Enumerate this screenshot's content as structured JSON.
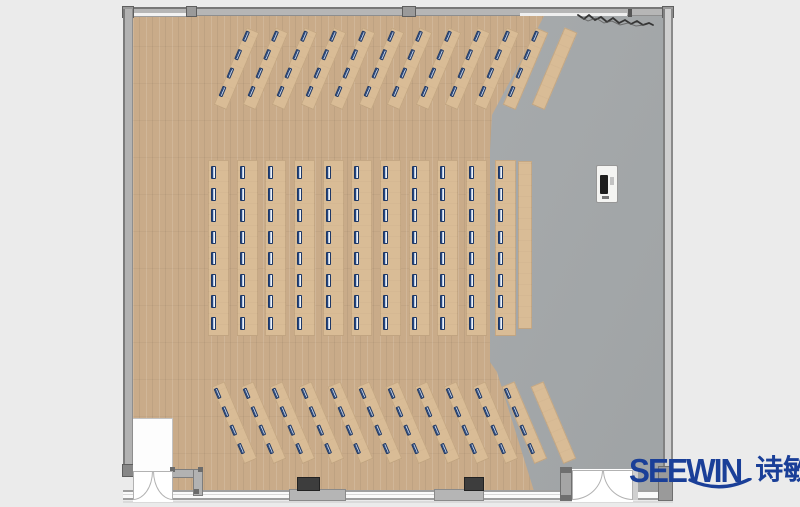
{
  "meta": {
    "title": "Training room floor plan (top view)",
    "floor_left": "wood plank",
    "floor_right": "gray"
  },
  "logo": {
    "brand": "SEEWIN",
    "cjk": "诗敏",
    "color": "#1a3f98"
  },
  "palette": {
    "background": "#ebebeb",
    "wood_floor": "#c9ab89",
    "gray_floor": "#a8acae",
    "desk": "#d9bc96",
    "seat_navy": "#1d3765",
    "wall": "#b6b6b6",
    "column_dark": "#3d3d3d",
    "logo_blue": "#1a3f98"
  },
  "furniture": {
    "blocks": [
      {
        "name": "top-desk-block",
        "angle": 23,
        "strips": 12,
        "seated": 11,
        "x": 246,
        "y": 30,
        "pitch": 28.9,
        "strip_w": 14,
        "strip_h": 84,
        "seat_offsets": [
          3,
          23,
          43,
          63
        ],
        "seat_w": 4,
        "seat_h": 11,
        "seat_x": 1
      },
      {
        "name": "middle-desk-block",
        "angle": 0,
        "strips": 11,
        "seated": 11,
        "x": 208,
        "y": 160,
        "pitch": 28.65,
        "strip_w": 21,
        "strip_h": 176,
        "seat_count": 8,
        "seat_y0": 6,
        "seat_pitch": 21.5,
        "seat_w": 5,
        "seat_h": 13,
        "seat_x": 3,
        "extra_empty": {
          "x": 518,
          "y": 161,
          "w": 14,
          "h": 168
        }
      },
      {
        "name": "bottom-desk-block",
        "angle": -23,
        "strips": 12,
        "seated": 11,
        "x": 211,
        "y": 384,
        "pitch": 29,
        "strip_w": 14,
        "strip_h": 84,
        "seat_offsets": [
          3,
          23,
          43,
          63
        ],
        "seat_w": 4,
        "seat_h": 11,
        "seat_x": 1
      }
    ],
    "seats_total": 176,
    "podium": {
      "present": true
    }
  }
}
